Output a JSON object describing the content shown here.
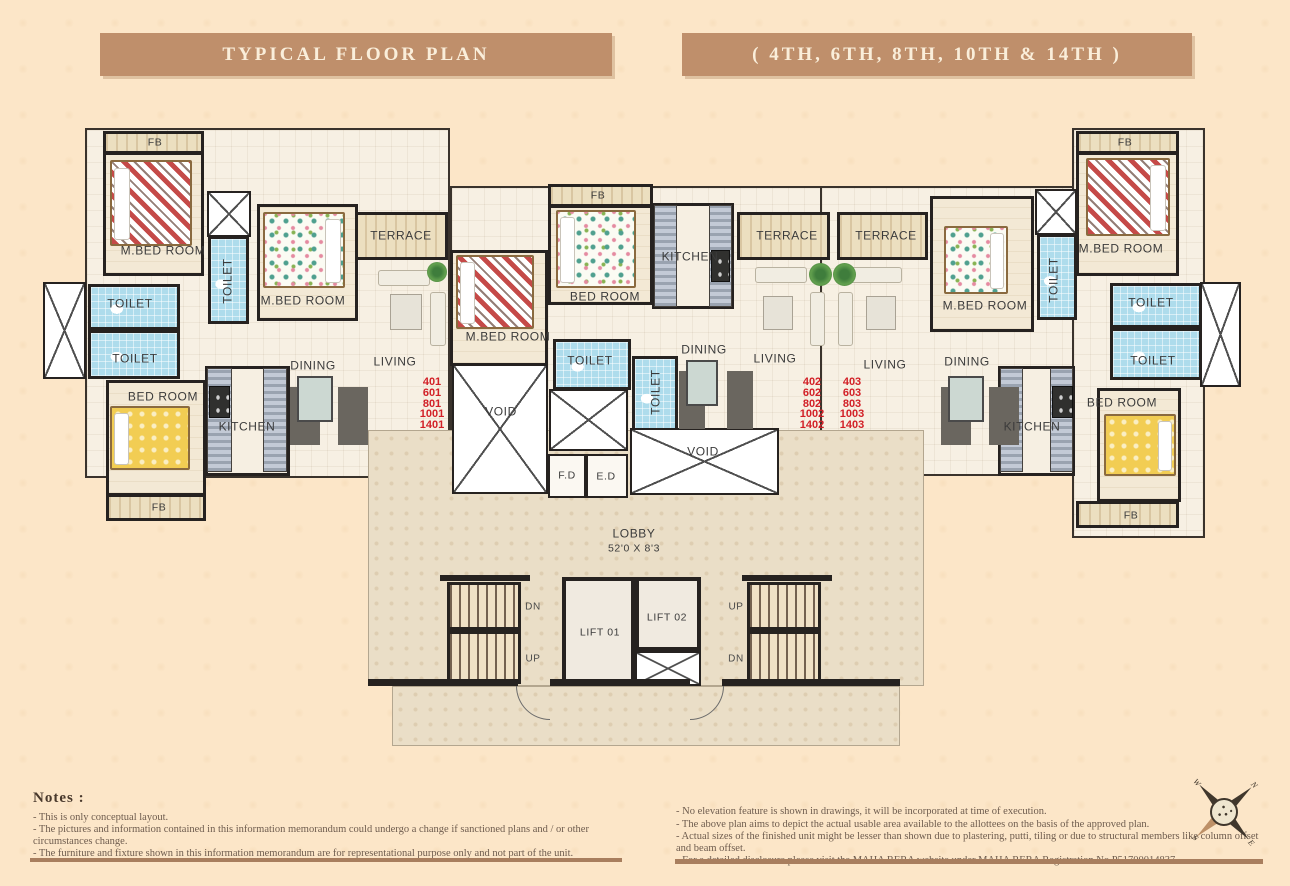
{
  "banners": {
    "left": "TYPICAL FLOOR PLAN",
    "right": "( 4TH, 6TH, 8TH, 10TH & 14TH )"
  },
  "plan": {
    "labels": [
      {
        "n": "label-fb-top-left",
        "t": "FB",
        "x": 155,
        "y": 143,
        "c": "sm"
      },
      {
        "n": "label-mbedroom-left",
        "t": "M.BED ROOM",
        "x": 163,
        "y": 251
      },
      {
        "n": "label-toilet-left-strip",
        "t": "TOILET",
        "x": 228,
        "y": 281,
        "c": "rot"
      },
      {
        "n": "label-mbedroom-left-2",
        "t": "M.BED ROOM",
        "x": 303,
        "y": 301
      },
      {
        "n": "label-terrace-left",
        "t": "TERRACE",
        "x": 401,
        "y": 236
      },
      {
        "n": "label-toilet-left-upper",
        "t": "TOILET",
        "x": 130,
        "y": 304
      },
      {
        "n": "label-toilet-left-lower",
        "t": "TOILET",
        "x": 135,
        "y": 359
      },
      {
        "n": "label-bedroom-left",
        "t": "BED ROOM",
        "x": 163,
        "y": 397
      },
      {
        "n": "label-kitchen-left",
        "t": "KITCHEN",
        "x": 247,
        "y": 427
      },
      {
        "n": "label-dining-left",
        "t": "DINING",
        "x": 313,
        "y": 366
      },
      {
        "n": "label-living-left",
        "t": "LIVING",
        "x": 395,
        "y": 362
      },
      {
        "n": "label-fb-bottom-left",
        "t": "FB",
        "x": 159,
        "y": 508,
        "c": "sm"
      },
      {
        "n": "label-fb-center",
        "t": "FB",
        "x": 598,
        "y": 196,
        "c": "sm"
      },
      {
        "n": "label-mbedroom-center",
        "t": "M.BED ROOM",
        "x": 508,
        "y": 337
      },
      {
        "n": "label-bedroom-center",
        "t": "BED ROOM",
        "x": 605,
        "y": 297
      },
      {
        "n": "label-kitchen-center",
        "t": "KITCHEN",
        "x": 690,
        "y": 257
      },
      {
        "n": "label-terrace-center-1",
        "t": "TERRACE",
        "x": 787,
        "y": 236
      },
      {
        "n": "label-terrace-center-2",
        "t": "TERRACE",
        "x": 886,
        "y": 236
      },
      {
        "n": "label-toilet-center",
        "t": "TOILET",
        "x": 590,
        "y": 361
      },
      {
        "n": "label-toilet-center-v",
        "t": "TOILET",
        "x": 656,
        "y": 392,
        "c": "rot"
      },
      {
        "n": "label-dining-center",
        "t": "DINING",
        "x": 704,
        "y": 350
      },
      {
        "n": "label-living-center",
        "t": "LIVING",
        "x": 775,
        "y": 359
      },
      {
        "n": "label-living-right",
        "t": "LIVING",
        "x": 885,
        "y": 365
      },
      {
        "n": "label-void-left",
        "t": "VOID",
        "x": 501,
        "y": 412
      },
      {
        "n": "label-void-right",
        "t": "VOID",
        "x": 703,
        "y": 452
      },
      {
        "n": "label-fd",
        "t": "F.D",
        "x": 567,
        "y": 476,
        "c": "sm"
      },
      {
        "n": "label-ed",
        "t": "E.D",
        "x": 606,
        "y": 477,
        "c": "sm"
      },
      {
        "n": "label-lobby",
        "t": "LOBBY",
        "x": 634,
        "y": 534
      },
      {
        "n": "label-lobby-dim",
        "t": "52'0 X 8'3",
        "x": 634,
        "y": 549,
        "c": "sm"
      },
      {
        "n": "label-mbedroom-right-2",
        "t": "M.BED ROOM",
        "x": 985,
        "y": 306
      },
      {
        "n": "label-toilet-right-strip",
        "t": "TOILET",
        "x": 1054,
        "y": 280,
        "c": "rot"
      },
      {
        "n": "label-mbedroom-right",
        "t": "M.BED ROOM",
        "x": 1121,
        "y": 249
      },
      {
        "n": "label-fb-top-right",
        "t": "FB",
        "x": 1125,
        "y": 143,
        "c": "sm"
      },
      {
        "n": "label-toilet-right-upper",
        "t": "TOILET",
        "x": 1151,
        "y": 303
      },
      {
        "n": "label-toilet-right-lower",
        "t": "TOILET",
        "x": 1153,
        "y": 361
      },
      {
        "n": "label-bedroom-right",
        "t": "BED ROOM",
        "x": 1122,
        "y": 403
      },
      {
        "n": "label-fb-bottom-right",
        "t": "FB",
        "x": 1131,
        "y": 516,
        "c": "sm"
      },
      {
        "n": "label-dining-right",
        "t": "DINING",
        "x": 967,
        "y": 362
      },
      {
        "n": "label-kitchen-right",
        "t": "KITCHEN",
        "x": 1032,
        "y": 427
      },
      {
        "n": "label-stair-left-dn",
        "t": "DN",
        "x": 533,
        "y": 607,
        "c": "dir"
      },
      {
        "n": "label-stair-left-up",
        "t": "UP",
        "x": 533,
        "y": 659,
        "c": "dir"
      },
      {
        "n": "label-lift-01",
        "t": "LIFT 01",
        "x": 600,
        "y": 633,
        "c": "sm"
      },
      {
        "n": "label-lift-02",
        "t": "LIFT 02",
        "x": 667,
        "y": 618,
        "c": "sm"
      },
      {
        "n": "label-stair-right-up",
        "t": "UP",
        "x": 736,
        "y": 607,
        "c": "dir"
      },
      {
        "n": "label-stair-right-dn",
        "t": "DN",
        "x": 736,
        "y": 659,
        "c": "dir"
      },
      {
        "n": "unit-numbers-401",
        "t": "401\n601\n801\n1001\n1401",
        "x": 432,
        "y": 404,
        "c": "unit"
      },
      {
        "n": "unit-numbers-402",
        "t": "402\n602\n802\n1002\n1402",
        "x": 812,
        "y": 404,
        "c": "unit"
      },
      {
        "n": "unit-numbers-403",
        "t": "403\n603\n803\n1003\n1403",
        "x": 852,
        "y": 404,
        "c": "unit"
      }
    ]
  },
  "notes_left": {
    "title": "Notes :",
    "items": [
      "- This is only conceptual layout.",
      "- The pictures and information contained in this information memorandum could undergo a change if sanctioned plans and / or other circumstances change.",
      "- The furniture and fixture shown in this information memorandum are for representational purpose only and not part of the unit."
    ]
  },
  "notes_right": {
    "items": [
      "- No elevation feature is shown in drawings, it will be incorporated at time of execution.",
      "- The above plan aims to depict the actual usable area available to the allottees on the basis of the approved plan.",
      "- Actual sizes of the finished unit might be lesser than shown due to plastering, putti, tiling or due to structural members like column offset and beam offset.",
      "- For a detailed disclosure please visit the MAHA RERA website under MAHA RERA Registration No.P51700014837."
    ]
  },
  "compass": {
    "n": "N",
    "e": "E",
    "s": "S",
    "w": "W"
  },
  "colors": {
    "banner": "#bf8f6b",
    "banner_text": "#faeeda",
    "unit_number_red": "#d22027",
    "toilet_blue": "#aedcec",
    "wall_dark": "#262220",
    "page_bg": "#fce6c8",
    "lobby_floor": "#eadec7"
  }
}
